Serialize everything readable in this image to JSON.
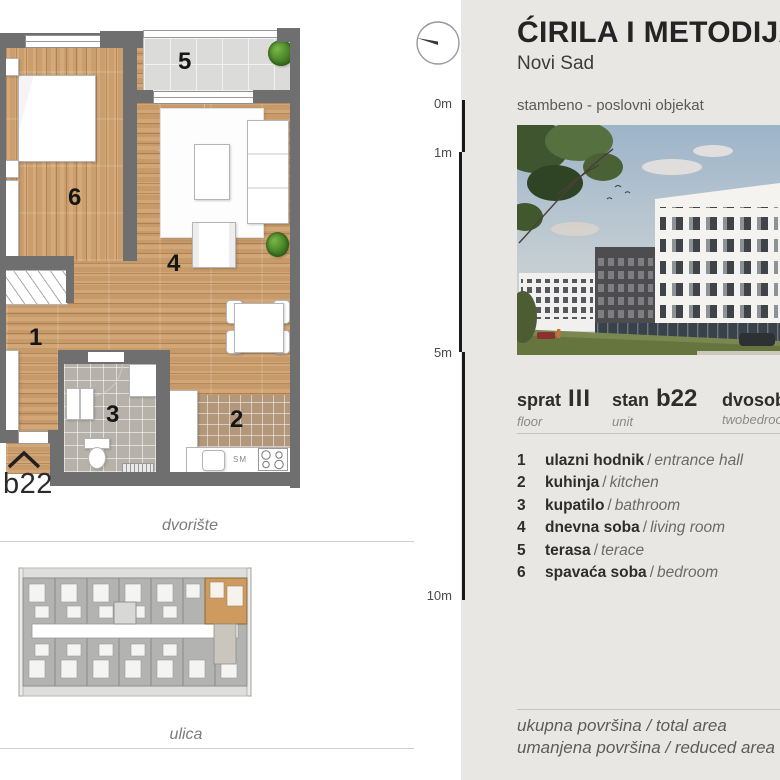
{
  "header": {
    "title": "ĆIRILA I METODIJA",
    "city": "Novi Sad",
    "project_type": "stambeno - poslovni objekat"
  },
  "scale": {
    "m0": "0m",
    "m1": "1m",
    "m5": "5m",
    "m10": "10m"
  },
  "unit_info": {
    "floor_label": "sprat",
    "floor_value": "III",
    "floor_sub": "floor",
    "unit_label": "stan",
    "unit_value": "b22",
    "unit_sub": "unit",
    "type_value": "dvosoban",
    "type_sub": "twobedroom"
  },
  "legend_sep": "/",
  "legend": [
    {
      "num": "1",
      "sr": "ulazni hodnik",
      "en": "entrance hall"
    },
    {
      "num": "2",
      "sr": "kuhinja",
      "en": "kitchen"
    },
    {
      "num": "3",
      "sr": "kupatilo",
      "en": "bathroom"
    },
    {
      "num": "4",
      "sr": "dnevna soba",
      "en": "living room"
    },
    {
      "num": "5",
      "sr": "terasa",
      "en": "terace"
    },
    {
      "num": "6",
      "sr": "spavaća soba",
      "en": "bedroom"
    }
  ],
  "areas": {
    "total": "ukupna površina / total area",
    "reduced": "umanjena površina / reduced area"
  },
  "plan": {
    "unit_code": "b22",
    "rooms": {
      "r1": "1",
      "r2": "2",
      "r3": "3",
      "r4": "4",
      "r5": "5",
      "r6": "6"
    },
    "courtyard": "dvorište",
    "street": "ulica",
    "counter_label": "SM"
  },
  "colors": {
    "accent_orange": "#cf9a5e",
    "panel_bg": "#e9e7e4",
    "wall_gray": "#6f6f6f",
    "wood": "#cfa06e"
  }
}
